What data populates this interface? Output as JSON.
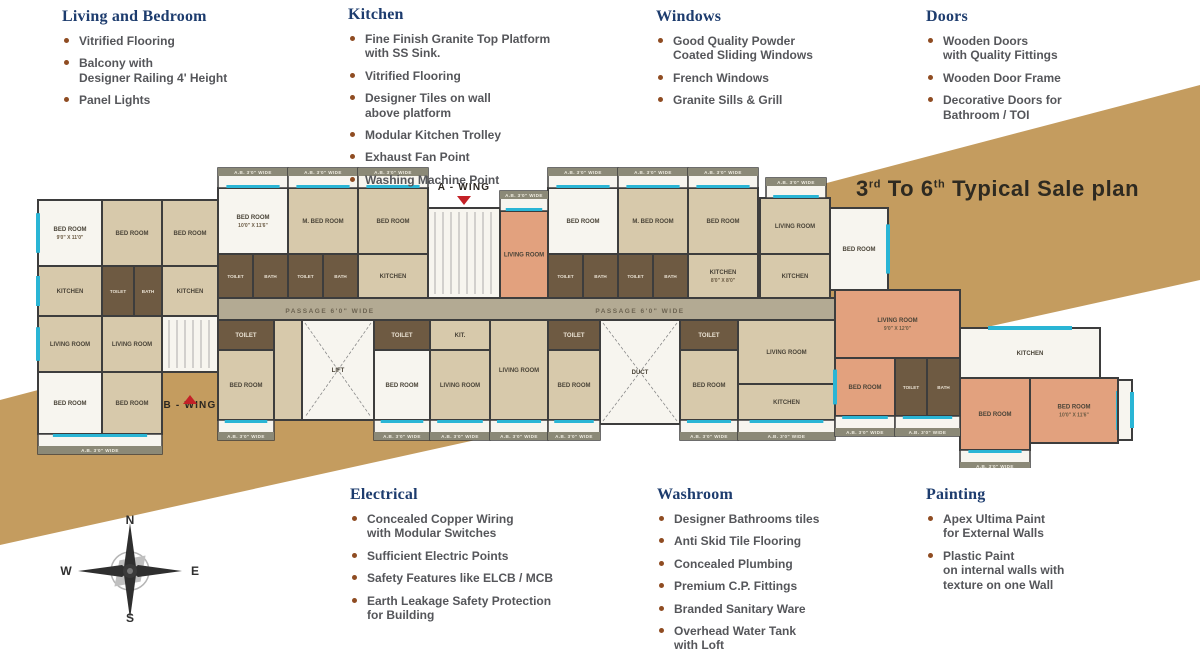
{
  "title": {
    "t1": "3",
    "s1": "rd",
    "t2": " To 6",
    "s2": "th",
    "t3": " Typical Sale plan"
  },
  "panels": [
    {
      "cls": "living",
      "title": "Living and Bedroom",
      "items": [
        "Vitrified Flooring",
        "Balcony with\nDesigner Railing 4' Height",
        "Panel Lights"
      ]
    },
    {
      "cls": "kitchen",
      "title": "Kitchen",
      "items": [
        "Fine Finish Granite Top Platform\nwith SS Sink.",
        "Vitrified Flooring",
        "Designer Tiles on wall\nabove platform",
        "Modular Kitchen Trolley",
        "Exhaust Fan Point",
        "Washing Machine Point"
      ]
    },
    {
      "cls": "windows",
      "title": "Windows",
      "items": [
        "Good Quality Powder\nCoated Sliding Windows",
        "French Windows",
        "Granite Sills & Grill"
      ]
    },
    {
      "cls": "doors",
      "title": "Doors",
      "items": [
        "Wooden Doors\nwith Quality Fittings",
        "Wooden Door  Frame",
        "Decorative Doors for\nBathroom / TOI"
      ]
    },
    {
      "cls": "electrical",
      "title": "Electrical",
      "items": [
        "Concealed Copper Wiring\nwith Modular Switches",
        "Sufficient Electric Points",
        "Safety Features like ELCB / MCB",
        "Earth Leakage Safety Protection\nfor Building"
      ]
    },
    {
      "cls": "washroom",
      "title": "Washroom",
      "items": [
        "Designer Bathrooms tiles",
        "Anti Skid Tile Flooring",
        "Concealed Plumbing",
        "Premium C.P. Fittings",
        "Branded Sanitary Ware",
        "Overhead Water Tank\nwith Loft"
      ]
    },
    {
      "cls": "painting",
      "title": "Painting",
      "items": [
        "Apex Ultima Paint\nfor External Walls",
        "Plastic Paint\non internal walls with\ntexture on one Wall"
      ]
    }
  ],
  "compass": {
    "north": "N",
    "south": "S",
    "east": "E",
    "west": "W"
  },
  "colors": {
    "accent_heading": "#1d3c6e",
    "bullet": "#8f4c22",
    "body_text": "#55565a",
    "band_gold": "#c49c5f",
    "title_text": "#2e2a21",
    "wall": "#3d3d3d",
    "beige": "#d7c9ab",
    "white_room": "#f7f5ef",
    "salmon": "#e2a17e",
    "tile": "#6e5a42",
    "balcony_header": "#8b8977",
    "passage": "#b3aa93",
    "window_cyan": "#2ab5d5",
    "wing_red": "#c42127",
    "wing_text": "#2b2620"
  },
  "floorplan": {
    "passage_label": "PASSAGE 6'0\" WIDE",
    "balcony_label": "A.B. 3'0\" WIDE",
    "wings": [
      {
        "label": "A - WING",
        "x": 434,
        "y": 42,
        "dir": "down"
      },
      {
        "label": "B - WING",
        "x": 160,
        "y": 260,
        "dir": "up"
      }
    ],
    "corridor": {
      "x": 188,
      "y": 150,
      "w": 617,
      "h": 22,
      "labels_x": [
        300,
        610
      ]
    },
    "rooms": [
      {
        "x": 8,
        "y": 52,
        "w": 64,
        "h": 66,
        "f": "white_room",
        "l": "BED ROOM",
        "d": "9'0\" X 11'0\"",
        "win": "l"
      },
      {
        "x": 8,
        "y": 118,
        "w": 64,
        "h": 50,
        "f": "beige",
        "l": "KITCHEN",
        "win": "l"
      },
      {
        "x": 8,
        "y": 168,
        "w": 64,
        "h": 56,
        "f": "beige",
        "l": "LIVING ROOM",
        "win": "l"
      },
      {
        "x": 8,
        "y": 224,
        "w": 64,
        "h": 62,
        "f": "white_room",
        "l": "BED ROOM"
      },
      {
        "x": 72,
        "y": 52,
        "w": 60,
        "h": 66,
        "f": "beige",
        "l": "BED ROOM"
      },
      {
        "x": 72,
        "y": 118,
        "w": 32,
        "h": 50,
        "f": "tile",
        "l": "TOILET"
      },
      {
        "x": 104,
        "y": 118,
        "w": 28,
        "h": 50,
        "f": "tile",
        "l": "BATH"
      },
      {
        "x": 72,
        "y": 168,
        "w": 60,
        "h": 56,
        "f": "beige",
        "l": "LIVING ROOM"
      },
      {
        "x": 72,
        "y": 224,
        "w": 60,
        "h": 62,
        "f": "beige",
        "l": "BED ROOM"
      },
      {
        "x": 132,
        "y": 52,
        "w": 56,
        "h": 66,
        "f": "beige",
        "l": "BED ROOM"
      },
      {
        "x": 132,
        "y": 118,
        "w": 56,
        "h": 50,
        "f": "beige",
        "l": "KITCHEN"
      },
      {
        "x": 132,
        "y": 168,
        "w": 56,
        "h": 56,
        "f": "white_room",
        "stair": true
      },
      {
        "x": 188,
        "y": 40,
        "w": 70,
        "h": 66,
        "f": "white_room",
        "l": "BED ROOM",
        "d": "10'0\" X 11'6\""
      },
      {
        "x": 258,
        "y": 40,
        "w": 70,
        "h": 66,
        "f": "beige",
        "l": "M. BED ROOM"
      },
      {
        "x": 328,
        "y": 40,
        "w": 70,
        "h": 66,
        "f": "beige",
        "l": "BED ROOM"
      },
      {
        "x": 188,
        "y": 106,
        "w": 35,
        "h": 44,
        "f": "tile",
        "l": "TOILET"
      },
      {
        "x": 223,
        "y": 106,
        "w": 35,
        "h": 44,
        "f": "tile",
        "l": "BATH"
      },
      {
        "x": 258,
        "y": 106,
        "w": 35,
        "h": 44,
        "f": "tile",
        "l": "TOILET"
      },
      {
        "x": 293,
        "y": 106,
        "w": 35,
        "h": 44,
        "f": "tile",
        "l": "BATH"
      },
      {
        "x": 328,
        "y": 106,
        "w": 70,
        "h": 44,
        "f": "beige",
        "l": "KITCHEN"
      },
      {
        "x": 398,
        "y": 60,
        "w": 72,
        "h": 90,
        "f": "white_room",
        "stair": true
      },
      {
        "x": 470,
        "y": 63,
        "w": 48,
        "h": 87,
        "f": "salmon",
        "l": "LIVING ROOM"
      },
      {
        "x": 518,
        "y": 40,
        "w": 70,
        "h": 66,
        "f": "white_room",
        "l": "BED ROOM"
      },
      {
        "x": 588,
        "y": 40,
        "w": 70,
        "h": 66,
        "f": "beige",
        "l": "M. BED ROOM"
      },
      {
        "x": 658,
        "y": 40,
        "w": 70,
        "h": 66,
        "f": "beige",
        "l": "BED ROOM"
      },
      {
        "x": 518,
        "y": 106,
        "w": 35,
        "h": 44,
        "f": "tile",
        "l": "TOILET"
      },
      {
        "x": 553,
        "y": 106,
        "w": 35,
        "h": 44,
        "f": "tile",
        "l": "BATH"
      },
      {
        "x": 588,
        "y": 106,
        "w": 35,
        "h": 44,
        "f": "tile",
        "l": "TOILET"
      },
      {
        "x": 623,
        "y": 106,
        "w": 35,
        "h": 44,
        "f": "tile",
        "l": "BATH"
      },
      {
        "x": 658,
        "y": 106,
        "w": 70,
        "h": 44,
        "f": "beige",
        "l": "KITCHEN",
        "d": "8'0\" X 8'0\""
      },
      {
        "x": 730,
        "y": 50,
        "w": 70,
        "h": 56,
        "f": "beige",
        "l": "LIVING ROOM"
      },
      {
        "x": 730,
        "y": 106,
        "w": 70,
        "h": 44,
        "f": "beige",
        "l": "KITCHEN"
      },
      {
        "x": 800,
        "y": 60,
        "w": 58,
        "h": 82,
        "f": "white_room",
        "l": "BED ROOM",
        "win": "r"
      },
      {
        "x": 188,
        "y": 172,
        "w": 56,
        "h": 30,
        "f": "tile",
        "l": "TOILET"
      },
      {
        "x": 188,
        "y": 202,
        "w": 56,
        "h": 70,
        "f": "beige",
        "l": "BED ROOM"
      },
      {
        "x": 244,
        "y": 172,
        "w": 28,
        "h": 100,
        "f": "beige"
      },
      {
        "x": 272,
        "y": 172,
        "w": 72,
        "h": 100,
        "f": "white_room",
        "cross": true,
        "l": "LIFT"
      },
      {
        "x": 344,
        "y": 172,
        "w": 56,
        "h": 30,
        "f": "tile",
        "l": "TOILET"
      },
      {
        "x": 344,
        "y": 202,
        "w": 56,
        "h": 70,
        "f": "white_room",
        "l": "BED ROOM"
      },
      {
        "x": 400,
        "y": 172,
        "w": 60,
        "h": 30,
        "f": "beige",
        "l": "KIT."
      },
      {
        "x": 400,
        "y": 202,
        "w": 60,
        "h": 70,
        "f": "beige",
        "l": "LIVING ROOM"
      },
      {
        "x": 460,
        "y": 172,
        "w": 58,
        "h": 100,
        "f": "beige",
        "l": "LIVING ROOM"
      },
      {
        "x": 518,
        "y": 172,
        "w": 52,
        "h": 30,
        "f": "tile",
        "l": "TOILET"
      },
      {
        "x": 518,
        "y": 202,
        "w": 52,
        "h": 70,
        "f": "beige",
        "l": "BED ROOM"
      },
      {
        "x": 570,
        "y": 172,
        "w": 80,
        "h": 104,
        "f": "white_room",
        "cross": true,
        "l": "DUCT"
      },
      {
        "x": 650,
        "y": 172,
        "w": 58,
        "h": 30,
        "f": "tile",
        "l": "TOILET"
      },
      {
        "x": 650,
        "y": 202,
        "w": 58,
        "h": 70,
        "f": "beige",
        "l": "BED ROOM"
      },
      {
        "x": 708,
        "y": 172,
        "w": 97,
        "h": 64,
        "f": "beige",
        "l": "LIVING ROOM"
      },
      {
        "x": 708,
        "y": 236,
        "w": 97,
        "h": 36,
        "f": "beige",
        "l": "KITCHEN"
      },
      {
        "x": 805,
        "y": 142,
        "w": 125,
        "h": 68,
        "f": "salmon",
        "l": "LIVING ROOM",
        "d": "9'0\" X 12'0\""
      },
      {
        "x": 805,
        "y": 210,
        "w": 60,
        "h": 58,
        "f": "salmon",
        "l": "BED ROOM",
        "win": "l"
      },
      {
        "x": 865,
        "y": 210,
        "w": 32,
        "h": 58,
        "f": "tile",
        "l": "TOILET"
      },
      {
        "x": 897,
        "y": 210,
        "w": 33,
        "h": 58,
        "f": "tile",
        "l": "BATH"
      },
      {
        "x": 930,
        "y": 180,
        "w": 140,
        "h": 50,
        "f": "white_room",
        "l": "KITCHEN",
        "win": "t"
      },
      {
        "x": 930,
        "y": 230,
        "w": 70,
        "h": 72,
        "f": "salmon",
        "l": "BED ROOM"
      },
      {
        "x": 1000,
        "y": 230,
        "w": 88,
        "h": 65,
        "f": "salmon",
        "l": "BED ROOM",
        "d": "10'0\" X 11'6\"",
        "win": "r"
      },
      {
        "x": 1088,
        "y": 232,
        "w": 14,
        "h": 60,
        "f": "white_room",
        "win": "r"
      }
    ],
    "balconies": [
      {
        "x": 188,
        "y": 20,
        "w": 70,
        "side": "t"
      },
      {
        "x": 258,
        "y": 20,
        "w": 70,
        "side": "t"
      },
      {
        "x": 328,
        "y": 20,
        "w": 70,
        "side": "t"
      },
      {
        "x": 470,
        "y": 43,
        "w": 48,
        "side": "t"
      },
      {
        "x": 518,
        "y": 20,
        "w": 70,
        "side": "t"
      },
      {
        "x": 588,
        "y": 20,
        "w": 70,
        "side": "t"
      },
      {
        "x": 658,
        "y": 20,
        "w": 70,
        "side": "t"
      },
      {
        "x": 736,
        "y": 30,
        "w": 60,
        "side": "t"
      },
      {
        "x": 8,
        "y": 286,
        "w": 124,
        "side": "b"
      },
      {
        "x": 188,
        "y": 272,
        "w": 56,
        "side": "b"
      },
      {
        "x": 344,
        "y": 272,
        "w": 56,
        "side": "b"
      },
      {
        "x": 400,
        "y": 272,
        "w": 60,
        "side": "b"
      },
      {
        "x": 460,
        "y": 272,
        "w": 58,
        "side": "b"
      },
      {
        "x": 518,
        "y": 272,
        "w": 52,
        "side": "b"
      },
      {
        "x": 650,
        "y": 272,
        "w": 58,
        "side": "b"
      },
      {
        "x": 708,
        "y": 272,
        "w": 97,
        "side": "b"
      },
      {
        "x": 805,
        "y": 268,
        "w": 60,
        "side": "b"
      },
      {
        "x": 865,
        "y": 268,
        "w": 65,
        "side": "b"
      },
      {
        "x": 930,
        "y": 302,
        "w": 70,
        "side": "b"
      }
    ]
  }
}
